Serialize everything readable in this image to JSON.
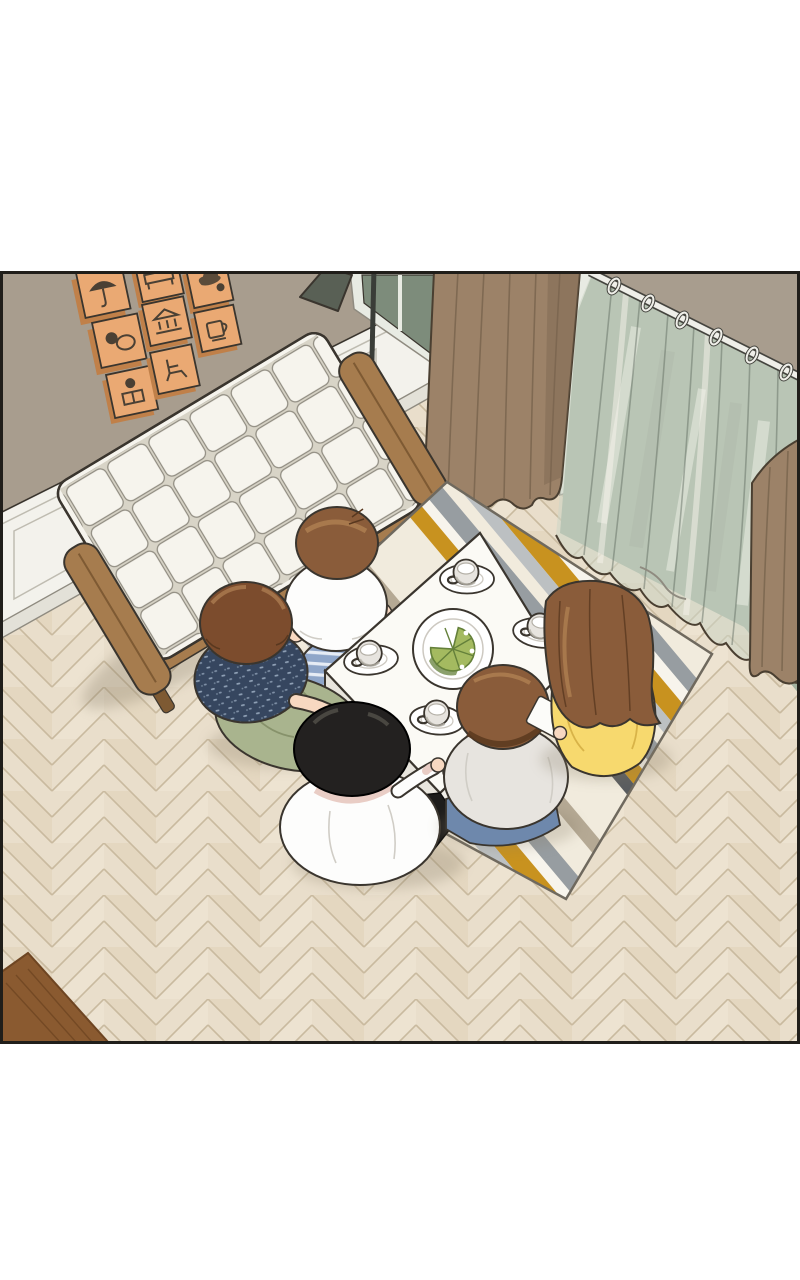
{
  "page": {
    "label": "Webtoon comic panel: overhead view of a living room where five people sit around a low white table",
    "background": "#ffffff"
  },
  "palette": {
    "white": "#ffffff",
    "outline": "#3a352e",
    "border": "#201e1a",
    "wall": "#a89d8e",
    "floor-base": "#e9decb",
    "floor-seam": "#c9ba9f",
    "floor-var": "#decfb4",
    "floor-var2": "#f2e8d7",
    "wainscot": "#f3f2ec",
    "wainscot-line": "#bfbcb1",
    "wainscot-base": "#e3e1d8",
    "wood": "#a67c4e",
    "wood-dark": "#7e5a33",
    "sofa": "#f6f4ed",
    "sofa-gap": "#d8d4c7",
    "sofa-line": "#8f8b80",
    "frame-face": "#eaa973",
    "frame-side": "#c08049",
    "frame-icon": "#4a4034",
    "lamp-shade": "#596055",
    "lamp-base": "#474c45",
    "lamp-pole": "#3a3d38",
    "curtain-brown": "#9c8268",
    "curtain-brown-dark": "#7c6750",
    "curtain-hem-line": "#4a3f31",
    "glass-green": "#a3b19f",
    "glass-green-dark": "#7d8c7b",
    "glass-frame": "#e8ebe3",
    "sheer": "#ccd6c6",
    "sheer-line": "#5c675c",
    "rod": "#efefe9",
    "rod-line": "#45453f",
    "rug-cream": "#f1ebdd",
    "rug-white": "#f7f4ec",
    "rug-gray": "#979da1",
    "rug-gray-light": "#bcc0c2",
    "rug-mustard": "#c8921f",
    "rug-charcoal": "#595c5f",
    "rug-taupe": "#b5a994",
    "rug-edge": "#6f695e",
    "table-top": "#fbfaf5",
    "table-side": "#e8e5dd",
    "table-side2": "#f1eee7",
    "plate": "#ffffff",
    "plate-line": "#cdc9c1",
    "cup-shade": "#b5b1a8",
    "cake": "#a4ba60",
    "cake-dark": "#64803a",
    "skin": "#f7d8c1",
    "hair-brown": "#8a5c3a",
    "hair-brown-hi": "#ab7c50",
    "hair-brown2": "#7c4c2d",
    "hair-dark-line": "#59381f",
    "hair-black": "#232120",
    "hair-black-hi": "#4e4b45",
    "shirt-white": "#fdfdfc",
    "shirt-gray": "#e7e4df",
    "shirt-fold": "#d0cdc6",
    "shirt-navy": "#36465f",
    "navy-speck": "#9fb0c5",
    "collar-pink": "#e9cdc5",
    "pants-sage": "#a9b48e",
    "sage-line": "#87926b",
    "pants-black": "#1d1c1b",
    "jeans": "#6e88ac",
    "jeans-line": "#55708f",
    "stripe-blue": "#8fa6c9",
    "stripe-light": "#e6ecf5",
    "yellow": "#f7d96e",
    "yellow-line": "#d8b348",
    "paper": "#fcfcf9",
    "shadow": "#857a65",
    "corner-wood": "#8a5a30",
    "corner-wood-line": "#6e4522"
  },
  "scene": {
    "room": {
      "label": "living room with taupe wall, white wainscoting and herringbone wood floor"
    },
    "wall_frames": {
      "count": 8,
      "label": "eight orange picture frames with small pictograms",
      "icons": [
        "umbrella",
        "bed",
        "cloud",
        "circles",
        "bank",
        "mug",
        "person-reading",
        "chair"
      ]
    },
    "sofa": {
      "label": "white tufted sofa with wooden arms and legs"
    },
    "lamp": {
      "label": "floor lamp with dark conical shade"
    },
    "curtains": {
      "left": "brown curtain panel",
      "sheer": "sheer green curtain hanging from white rod with rings",
      "right": "brown curtain panel at far right"
    },
    "rug": {
      "label": "geometric striped area rug",
      "colors": [
        "cream",
        "gray",
        "mustard",
        "charcoal",
        "taupe"
      ]
    },
    "table": {
      "label": "low white rectangular table",
      "plate": "round plate with green cake cut into slices",
      "cups": 4
    },
    "people": [
      {
        "id": "top",
        "label": "person with brown bob hair, white t-shirt and blue striped pants"
      },
      {
        "id": "left",
        "label": "person with brown wavy hair, navy patterned shirt and sage green pants"
      },
      {
        "id": "bottom",
        "label": "person with black hair, white long-sleeve shirt and black pants holding a spoon"
      },
      {
        "id": "bottom-right",
        "label": "person with brown hair, light gray shirt and blue jeans"
      },
      {
        "id": "right",
        "label": "person with long brown hair and yellow top, white paper beside them"
      }
    ],
    "misc": {
      "corner_furniture": "corner of wooden furniture at bottom left"
    }
  }
}
